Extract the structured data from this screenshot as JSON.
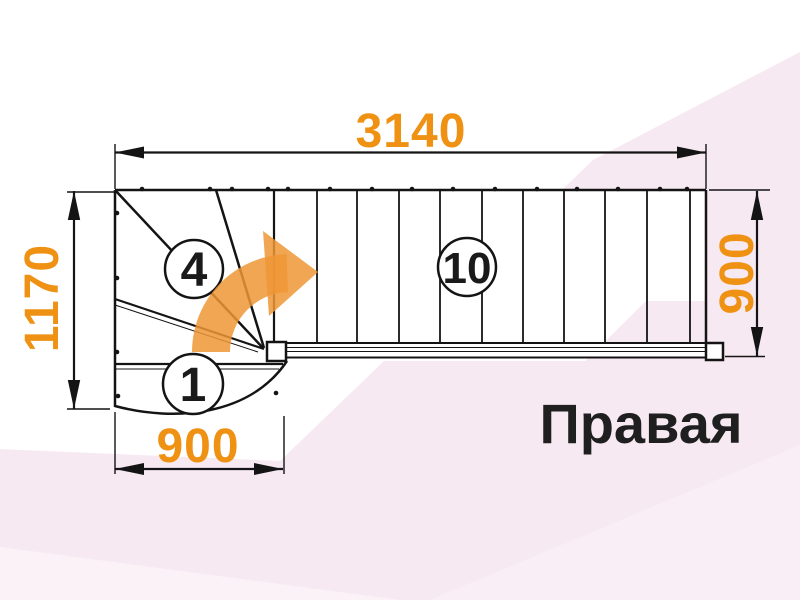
{
  "diagram": {
    "orientation_label": "Правая",
    "dimensions": {
      "top_length": "3140",
      "left_height": "1170",
      "bottom_width": "900",
      "right_width": "900"
    },
    "steps": {
      "first_step": "1",
      "winder_step": "4",
      "straight_step": "10"
    },
    "colors": {
      "dimension_text": "#EF9113",
      "arrow_fill": "#EF9636",
      "line": "#141414",
      "label_text": "#1F1F1F",
      "background_pink": "#F7E9F2"
    }
  }
}
